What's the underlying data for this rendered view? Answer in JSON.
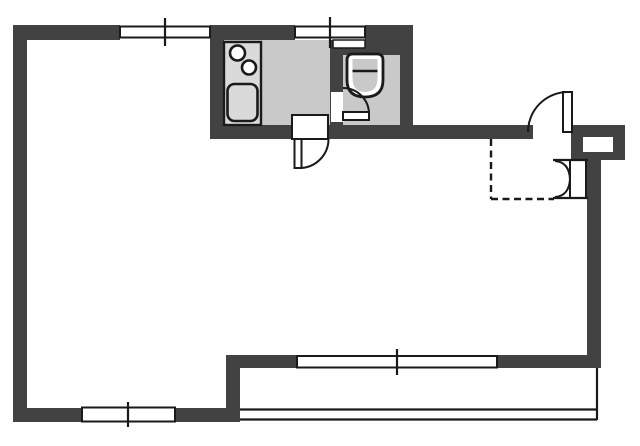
{
  "meta": {
    "description": "scanned apartment floor plan, no text labels",
    "elements": [
      "main-room",
      "kitchen",
      "toilet-room",
      "entrance",
      "balcony"
    ]
  },
  "canvas": {
    "width": 640,
    "height": 446,
    "background": "#fefefe"
  },
  "palette": {
    "wall": "#424242",
    "outline": "#1a1a1a",
    "floor": "#c9c9c9",
    "counter": "#dadada",
    "white": "#ffffff"
  },
  "plan": {
    "floors": [
      {
        "name": "kitchen-floor",
        "x": 224,
        "y": 40,
        "w": 106,
        "h": 86
      },
      {
        "name": "toilet-floor",
        "x": 343,
        "y": 55,
        "w": 57,
        "h": 71
      }
    ],
    "walls": [
      {
        "name": "top-wall-left",
        "x": 13,
        "y": 25,
        "w": 107,
        "h": 15
      },
      {
        "name": "top-wall-mid",
        "x": 210,
        "y": 25,
        "w": 85,
        "h": 15
      },
      {
        "name": "top-wall-right",
        "x": 365,
        "y": 25,
        "w": 48,
        "h": 15
      },
      {
        "name": "left-wall",
        "x": 13,
        "y": 25,
        "w": 14,
        "h": 397
      },
      {
        "name": "kitchen-left-wall",
        "x": 210,
        "y": 40,
        "w": 14,
        "h": 99
      },
      {
        "name": "kitchen-toilet-divider-wall",
        "x": 330,
        "y": 40,
        "w": 13,
        "h": 99
      },
      {
        "name": "toilet-right-wall",
        "x": 400,
        "y": 40,
        "w": 13,
        "h": 99
      },
      {
        "name": "toilet-top-wall",
        "x": 330,
        "y": 40,
        "w": 83,
        "h": 15
      },
      {
        "name": "service-wall",
        "x": 210,
        "y": 125,
        "w": 323,
        "h": 14
      },
      {
        "name": "entry-block",
        "x": 571,
        "y": 125,
        "w": 54,
        "h": 35
      },
      {
        "name": "right-wall",
        "x": 587,
        "y": 160,
        "w": 14,
        "h": 208
      },
      {
        "name": "bottom-right-wall",
        "x": 497,
        "y": 355,
        "w": 104,
        "h": 13
      },
      {
        "name": "step-wall-horizontal",
        "x": 226,
        "y": 355,
        "w": 71,
        "h": 13
      },
      {
        "name": "step-wall-vertical",
        "x": 226,
        "y": 355,
        "w": 14,
        "h": 67
      },
      {
        "name": "bottom-wall",
        "x": 13,
        "y": 408,
        "w": 213,
        "h": 14
      }
    ],
    "cutouts": [
      {
        "name": "kitchen-door-threshold",
        "x": 292,
        "y": 115,
        "w": 36,
        "h": 24,
        "stroke_w": 2
      },
      {
        "name": "toilet-door-gap",
        "x": 331,
        "y": 92,
        "w": 12,
        "h": 30,
        "stroke_w": 0
      },
      {
        "name": "entrance-door-gap",
        "x": 533,
        "y": 125,
        "w": 38,
        "h": 14,
        "stroke_w": 0
      },
      {
        "name": "shoe-box-niche",
        "x": 583,
        "y": 137,
        "w": 30,
        "h": 15,
        "stroke_w": 0
      },
      {
        "name": "toilet-window-inset",
        "x": 333,
        "y": 40,
        "w": 32,
        "h": 8,
        "stroke_w": 1.5
      }
    ],
    "windows": [
      {
        "name": "window-top-left",
        "x": 120,
        "y": 26.5,
        "w": 90,
        "h": 11,
        "tick_x": 165,
        "tick_y1": 18,
        "tick_y2": 46
      },
      {
        "name": "window-top-kitchen",
        "x": 295,
        "y": 26.5,
        "w": 70,
        "h": 11,
        "tick_x": 330,
        "tick_y1": 17,
        "tick_y2": 48
      },
      {
        "name": "window-bottom-left",
        "x": 82,
        "y": 407.5,
        "w": 93,
        "h": 14,
        "tick_x": 128,
        "tick_y1": 402,
        "tick_y2": 427
      },
      {
        "name": "window-bottom-right",
        "x": 297,
        "y": 356,
        "w": 200,
        "h": 11.5,
        "tick_x": 397,
        "tick_y1": 349,
        "tick_y2": 375
      }
    ],
    "kitchen_fixtures": {
      "counter": {
        "name": "kitchen-counter",
        "x": 224,
        "y": 42,
        "w": 37,
        "h": 83
      },
      "burners": [
        {
          "name": "stove-burner-1",
          "cx": 237.5,
          "cy": 53,
          "r": 7.5
        },
        {
          "name": "stove-burner-2",
          "cx": 249,
          "cy": 67.5,
          "r": 7
        }
      ],
      "sink": {
        "name": "kitchen-sink",
        "x": 227.5,
        "y": 84,
        "w": 30,
        "h": 37,
        "rx": 7
      }
    },
    "toilet_fixture": {
      "outer_path": "M 353 54 L 377 54 Q 383 54 383 60 L 383 80 Q 383 97 365 97 Q 347 97 347 80 L 347 60 Q 347 54 353 54 Z",
      "inner_path": "M 352.5 59 L 377.5 59 L 377.5 78 Q 377.5 92 365 92 Q 352.5 92 352.5 78 Z",
      "seat_line": "M 352.5 71 L 377.5 71"
    },
    "doors": [
      {
        "name": "kitchen-door",
        "leaf": {
          "x": 294.5,
          "y": 139,
          "w": 7,
          "h": 29
        },
        "arc": "M 328.5 139 A 29 29 0 0 1 299.5 168"
      },
      {
        "name": "toilet-door",
        "leaf": {
          "x": 343,
          "y": 112,
          "w": 26,
          "h": 8
        },
        "arc": "M 369 114 A 26 26 0 0 0 343 88"
      },
      {
        "name": "entrance-door",
        "leaf": {
          "x": 563,
          "y": 92,
          "w": 9,
          "h": 40
        },
        "arc": "M 528 132 A 40 40 0 0 1 568 92"
      },
      {
        "name": "closet-door",
        "leaf": {
          "x": 570,
          "y": 160,
          "w": 16,
          "h": 38
        },
        "arc": "M 555 161 Q 569 162 570 179 M 555 197 Q 569 196 570 179"
      }
    ],
    "solid_lines": [
      {
        "name": "closet-top-line",
        "d": "M 553 160 L 588 160",
        "w": 2.2
      },
      {
        "name": "closet-base-line",
        "d": "M 553 198 L 588 198",
        "w": 2.2
      },
      {
        "name": "balcony-right-rail",
        "d": "M 597 368 L 597 420",
        "w": 2.2
      },
      {
        "name": "balcony-rail-outer",
        "d": "M 240 409.5 L 597 409.5",
        "w": 2.2
      },
      {
        "name": "balcony-rail-inner",
        "d": "M 240 419.5 L 597 419.5",
        "w": 2.2
      }
    ],
    "dashed_lines": [
      {
        "name": "entrance-step-dashed-vertical",
        "d": "M 491 139 L 491 199",
        "w": 2.4
      },
      {
        "name": "entrance-step-dashed-horizontal",
        "d": "M 491 199 L 554 199",
        "w": 2.4
      }
    ]
  }
}
